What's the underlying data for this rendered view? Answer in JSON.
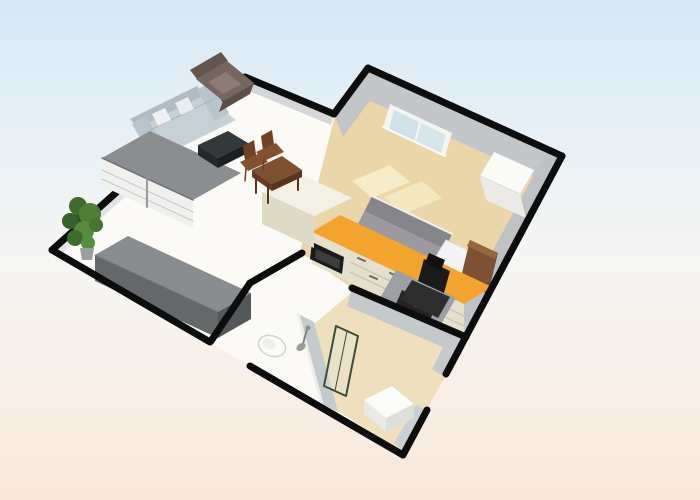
{
  "canvas": {
    "width": 700,
    "height": 500
  },
  "background": {
    "top": "#d7e9f7",
    "mid": "#f6f6f4",
    "bottom": "#f9e8da"
  },
  "scene": {
    "description": "3d-floor-plan-render",
    "shapes": [
      {
        "n": "apartment-floor",
        "t": "poly",
        "p": "52,250 245,77 334,114 368,68 562,156 403,455",
        "f": "#fbfaf6"
      },
      {
        "n": "bedroom-floor",
        "t": "poly",
        "p": "336,112 368,68 562,156 466,337 352,288 300,252",
        "f": "#ebd6a9"
      },
      {
        "n": "bedroom-rug-1",
        "t": "poly",
        "p": "352,181 390,165 410,182 372,198",
        "f": "#f6ecc8"
      },
      {
        "n": "bedroom-rug-2",
        "t": "poly",
        "p": "384,197 422,181 442,198 404,214",
        "f": "#f3e8c0"
      },
      {
        "n": "bathroom-floor",
        "t": "poly",
        "p": "314,324 352,292 466,339 403,452 336,410",
        "f": "#eedfbd"
      },
      {
        "n": "wall-face-top-left",
        "t": "poly",
        "p": "52,250 245,77 251,84 58,257",
        "f": "#e2e3e4"
      },
      {
        "n": "wall-face-notch",
        "t": "poly",
        "p": "245,77 334,114 331,125 242,88",
        "f": "#d4d6d8"
      },
      {
        "n": "wall-face-bedroom-left",
        "t": "poly",
        "p": "334,114 368,68 377,91 343,137",
        "f": "#c2c5c8"
      },
      {
        "n": "wall-face-bedroom-window",
        "t": "poly",
        "p": "368,71 560,159 549,183 357,95",
        "f": "#c4c7ca"
      },
      {
        "n": "window-frame",
        "t": "poly",
        "p": "390,104 452,133 445,156 383,127",
        "f": "#f4f4f1"
      },
      {
        "n": "window-pane-left",
        "t": "poly",
        "p": "394,110 419,122 414,141 389,129",
        "f": "#cfe2e6"
      },
      {
        "n": "window-pane-right",
        "t": "poly",
        "p": "421,123 446,135 441,153 416,142",
        "f": "#d5e7ea"
      },
      {
        "n": "window-sill",
        "t": "line",
        "p": "383,127 445,156",
        "s": "#fdfdfd",
        "w": 2
      },
      {
        "n": "wall-face-bedroom-right",
        "t": "poly",
        "p": "560,159 470,324 457,316 547,151",
        "f": "#bfc2c5"
      },
      {
        "n": "wall-face-bathroom-right",
        "t": "poly",
        "p": "470,324 443,376 432,369 459,317",
        "f": "#c6c9cb"
      },
      {
        "n": "wall-face-bathroom-right-lower",
        "t": "poly",
        "p": "427,413 404,452 394,443 417,404",
        "f": "#cdd0d2"
      },
      {
        "n": "wall-face-bathroom-top",
        "t": "poly",
        "p": "352,288 466,337 461,355 347,306",
        "f": "#c6c9cb"
      },
      {
        "n": "wall-face-bathroom-left",
        "t": "poly",
        "p": "298,314 322,404 338,412 314,322",
        "f": "#c7cacc"
      },
      {
        "n": "wall-edge-bathroom-left",
        "t": "line",
        "p": "298,314 322,404",
        "s": "#eceeee",
        "w": 3
      },
      {
        "n": "shower-arm",
        "t": "line",
        "p": "307,329 303,344",
        "s": "#7f8486",
        "w": 2
      },
      {
        "n": "shower-head",
        "t": "ell",
        "cx": 301,
        "cy": 347,
        "rx": 5,
        "ry": 3.5,
        "rot": -35,
        "f": "#989da0"
      },
      {
        "n": "shower-valve",
        "t": "ell",
        "cx": 308,
        "cy": 328,
        "rx": 2.5,
        "ry": 2.5,
        "rot": 0,
        "f": "#8a8f92"
      },
      {
        "n": "wall-top-left",
        "t": "line",
        "p": "52,250 245,77",
        "s": "#0d0d0d",
        "w": 7
      },
      {
        "n": "wall-notch",
        "t": "line",
        "p": "245,77 334,114",
        "s": "#0d0d0d",
        "w": 7
      },
      {
        "n": "bed-duvet",
        "t": "poly",
        "p": "372,196 452,234 424,290 344,252",
        "f": "#9b9b9e"
      },
      {
        "n": "bed-duvet-fold",
        "t": "poly",
        "p": "372,196 452,234 445,249 365,211",
        "f": "#85858b"
      },
      {
        "n": "bed-edge",
        "t": "line",
        "p": "372,196 452,234",
        "s": "#efeff1",
        "w": 2
      },
      {
        "n": "bed-pillow-1",
        "t": "poly",
        "p": "446,240 482,257 466,283 430,266",
        "f": "#f4f4f6",
        "s": "#dcdce0",
        "w": 1
      },
      {
        "n": "bed-pillow-2",
        "t": "poly",
        "p": "434,264 470,281 456,304 420,287",
        "f": "#ededf0",
        "s": "#d8d8dc",
        "w": 1
      },
      {
        "n": "bed-headboard",
        "t": "poly",
        "p": "470,240 498,253 488,294 460,281",
        "f": "#7c5134"
      },
      {
        "n": "bed-headboard-edge",
        "t": "poly",
        "p": "470,240 498,253 495,259 467,246",
        "f": "#96663e"
      },
      {
        "n": "wardrobe-top",
        "t": "poly",
        "p": "494,152 534,170 520,194 480,176",
        "f": "#fafaf7"
      },
      {
        "n": "wardrobe-front",
        "t": "poly",
        "p": "480,176 520,194 526,218 486,200",
        "f": "#ebeae6"
      },
      {
        "n": "wardrobe-edge",
        "t": "line",
        "p": "480,176 520,194",
        "s": "#dddddb",
        "w": 1
      },
      {
        "n": "kitchen-counter-top",
        "t": "poly",
        "p": "312,232 464,304 492,287 340,215",
        "f": "#f2a42e"
      },
      {
        "n": "kitchen-counter-front",
        "t": "poly",
        "p": "312,232 464,304 464,336 312,264",
        "f": "#e4e0cc"
      },
      {
        "n": "kitchen-drawer-seam",
        "t": "line",
        "p": "350,262 464,316",
        "s": "#cbc7b4",
        "w": 1.5
      },
      {
        "n": "kitchen-drawer-seam",
        "t": "line",
        "p": "350,272 464,326",
        "s": "#cbc7b4",
        "w": 1.5
      },
      {
        "n": "oven",
        "t": "poly",
        "p": "312,242 344,257 342,274 310,259",
        "f": "#1a1a1a"
      },
      {
        "n": "oven-glass",
        "t": "poly",
        "p": "316,249 340,260 339,269 315,258",
        "f": "#3d3d3d"
      },
      {
        "n": "kitchen-drawer-handle",
        "t": "line",
        "p": "358,258 365,261",
        "s": "#6a6a5e",
        "w": 2
      },
      {
        "n": "kitchen-drawer-handle",
        "t": "line",
        "p": "370,276 377,279",
        "s": "#6a6a5e",
        "w": 2
      },
      {
        "n": "kitchen-drawer-handle",
        "t": "line",
        "p": "390,273 397,276",
        "s": "#6a6a5e",
        "w": 2
      },
      {
        "n": "kitchen-drawer-handle",
        "t": "line",
        "p": "402,291 409,294",
        "s": "#6a6a5e",
        "w": 2
      },
      {
        "n": "kitchen-drawer-handle",
        "t": "line",
        "p": "422,288 429,291",
        "s": "#6a6a5e",
        "w": 2
      },
      {
        "n": "kitchen-drawer-handle",
        "t": "line",
        "p": "434,306 441,309",
        "s": "#6a6a5e",
        "w": 2
      },
      {
        "n": "kitchen-tall-cabinet-top",
        "t": "poly",
        "p": "262,192 300,174 352,198 314,216",
        "f": "#f3f1e5"
      },
      {
        "n": "kitchen-tall-cabinet-front",
        "t": "poly",
        "p": "262,192 314,216 314,248 262,224",
        "f": "#dedac5"
      },
      {
        "n": "desk-chair-mat",
        "t": "poly",
        "p": "396,270 456,298 440,326 380,298",
        "f": "#9aa0a3"
      },
      {
        "n": "hob-base",
        "t": "poly",
        "p": "402,290 436,306 430,320 396,304",
        "f": "#232323"
      },
      {
        "n": "hob-burner-red",
        "t": "ell",
        "cx": 417,
        "cy": 303,
        "rx": 7,
        "ry": 4.5,
        "rot": 25,
        "f": "#c22f2b"
      },
      {
        "n": "hob-burner-red-small",
        "t": "ell",
        "cx": 427,
        "cy": 309,
        "rx": 4,
        "ry": 3,
        "rot": 25,
        "f": "#9e1f1f"
      },
      {
        "n": "office-chair-seat",
        "t": "poly",
        "p": "412,280 450,297 438,318 400,299",
        "f": "#2d2d2d"
      },
      {
        "n": "office-chair-back",
        "t": "poly",
        "p": "424,259 450,271 444,293 418,281",
        "f": "#1a1a1a"
      },
      {
        "n": "office-chair-headrest",
        "t": "poly",
        "p": "429,253 445,260 441,270 425,263",
        "f": "#111111"
      },
      {
        "n": "sofa-back",
        "t": "poly",
        "p": "130,119 197,86 205,95 138,128",
        "f": "#b0bbc3"
      },
      {
        "n": "sofa-base",
        "t": "poly",
        "p": "138,128 205,95 236,120 169,153",
        "f": "#c6d0d7"
      },
      {
        "n": "sofa-armrest-left",
        "t": "poly",
        "p": "132,124 146,116 164,147 150,155",
        "f": "#bac4cb"
      },
      {
        "n": "sofa-armrest-right",
        "t": "poly",
        "p": "197,90 211,82 229,113 215,121",
        "f": "#bac4cb"
      },
      {
        "n": "sofa-seam",
        "t": "line",
        "p": "150,130 214,99",
        "s": "#a8b5bd",
        "w": 1
      },
      {
        "n": "sofa-pillow-1",
        "t": "poly",
        "p": "152,114 165,108 171,120 158,126",
        "f": "#eef1f3"
      },
      {
        "n": "sofa-pillow-2",
        "t": "poly",
        "p": "175,103 188,97 194,109 181,115",
        "f": "#e8edf0"
      },
      {
        "n": "sideboard-top",
        "t": "poly",
        "p": "102,158 150,131 241,173 193,200",
        "f": "#8b8e91"
      },
      {
        "n": "sideboard-front",
        "t": "poly",
        "p": "102,158 193,200 193,228 102,186",
        "f": "#f0f0ee"
      },
      {
        "n": "sideboard-edge",
        "t": "line",
        "p": "102,158 193,200",
        "s": "#6f7274",
        "w": 1.5
      },
      {
        "n": "sideboard-seam",
        "t": "line",
        "p": "102,170 193,212",
        "s": "#c6c6c6",
        "w": 1
      },
      {
        "n": "sideboard-seam",
        "t": "line",
        "p": "102,179 193,221",
        "s": "#c6c6c6",
        "w": 1
      },
      {
        "n": "sideboard-divider",
        "t": "line",
        "p": "147,179 147,207",
        "s": "#9a9a9a",
        "w": 2
      },
      {
        "n": "armchair-back",
        "t": "poly",
        "p": "190,70 221,52 228,61 197,79",
        "f": "#64544f"
      },
      {
        "n": "armchair-body",
        "t": "poly",
        "p": "196,79 227,61 254,83 223,101",
        "f": "#776561"
      },
      {
        "n": "armchair-seat",
        "t": "poly",
        "p": "208,82 226,72 241,84 223,94",
        "f": "#8d7b76"
      },
      {
        "n": "armchair-front",
        "t": "poly",
        "p": "223,101 254,83 250,94 219,112",
        "f": "#5e4e4a"
      },
      {
        "n": "coffee-table-top",
        "t": "poly",
        "p": "198,145 228,131 248,143 218,158",
        "f": "#33383a"
      },
      {
        "n": "coffee-table-front",
        "t": "poly",
        "p": "198,145 218,158 218,168 198,155",
        "f": "#24282a"
      },
      {
        "n": "coffee-table-side",
        "t": "poly",
        "p": "218,158 248,143 248,153 218,168",
        "f": "#1d2022"
      },
      {
        "n": "dining-chair-back",
        "t": "poly",
        "p": "261,136 272,130 275,152 264,158",
        "f": "#6f4226"
      },
      {
        "n": "dining-chair-seat",
        "t": "poly",
        "p": "256,152 276,143 284,152 264,161",
        "f": "#82522e"
      },
      {
        "n": "dining-chair-back",
        "t": "poly",
        "p": "243,146 254,140 257,162 246,168",
        "f": "#6f4226"
      },
      {
        "n": "dining-chair-seat",
        "t": "poly",
        "p": "240,162 260,153 268,162 248,171",
        "f": "#82522e"
      },
      {
        "n": "dining-table-top",
        "t": "poly",
        "p": "252,170 282,156 302,170 272,184",
        "f": "#7e5130"
      },
      {
        "n": "dining-table-front",
        "t": "poly",
        "p": "252,170 272,184 272,191 252,177",
        "f": "#663c22"
      },
      {
        "n": "dining-table-side",
        "t": "poly",
        "p": "272,184 302,170 302,177 272,191",
        "f": "#5a341d"
      },
      {
        "n": "dining-table-leg",
        "t": "line",
        "p": "256,176 256,193",
        "s": "#5a341d",
        "w": 2
      },
      {
        "n": "dining-table-leg",
        "t": "line",
        "p": "298,174 298,190",
        "s": "#5a341d",
        "w": 2
      },
      {
        "n": "dining-table-leg",
        "t": "line",
        "p": "268,186 268,203",
        "s": "#5a341d",
        "w": 2
      },
      {
        "n": "dining-chair-leg",
        "t": "line",
        "p": "246,168 245,181",
        "s": "#6f4226",
        "w": 1.5
      },
      {
        "n": "dining-chair-leg",
        "t": "line",
        "p": "264,158 263,171",
        "s": "#6f4226",
        "w": 1.5
      },
      {
        "n": "potted-plant-foliage",
        "t": "ell",
        "cx": 82,
        "cy": 222,
        "rx": 12,
        "ry": 12,
        "rot": 0,
        "f": "#2e5522"
      },
      {
        "n": "potted-plant-foliage",
        "t": "ell",
        "cx": 78,
        "cy": 206,
        "rx": 9,
        "ry": 9,
        "rot": 0,
        "f": "#3e6c2c"
      },
      {
        "n": "potted-plant-foliage",
        "t": "ell",
        "cx": 90,
        "cy": 214,
        "rx": 11,
        "ry": 11,
        "rot": 0,
        "f": "#4d8034"
      },
      {
        "n": "potted-plant-foliage",
        "t": "ell",
        "cx": 70,
        "cy": 221,
        "rx": 8,
        "ry": 8,
        "rot": 0,
        "f": "#35612a"
      },
      {
        "n": "potted-plant-foliage",
        "t": "ell",
        "cx": 84,
        "cy": 231,
        "rx": 10,
        "ry": 10,
        "rot": 0,
        "f": "#578c3c"
      },
      {
        "n": "potted-plant-foliage",
        "t": "ell",
        "cx": 96,
        "cy": 225,
        "rx": 7,
        "ry": 7,
        "rot": 0,
        "f": "#477433"
      },
      {
        "n": "potted-plant-foliage",
        "t": "ell",
        "cx": 75,
        "cy": 238,
        "rx": 8,
        "ry": 8,
        "rot": 0,
        "f": "#3e6c2c"
      },
      {
        "n": "potted-plant-foliage",
        "t": "ell",
        "cx": 88,
        "cy": 243,
        "rx": 7,
        "ry": 7,
        "rot": 0,
        "f": "#529040"
      },
      {
        "n": "plant-pot",
        "t": "poly",
        "p": "80,248 94,248 92,260 82,260",
        "f": "#9aa0a2"
      },
      {
        "n": "storage-box-top",
        "t": "poly",
        "p": "95,255 218,312 251,293 128,236",
        "f": "#898d90"
      },
      {
        "n": "storage-box-front",
        "t": "poly",
        "p": "95,255 218,312 218,338 95,281",
        "f": "#64686b"
      },
      {
        "n": "storage-box-end",
        "t": "poly",
        "p": "218,312 251,293 251,319 218,338",
        "f": "#55585b"
      },
      {
        "n": "storage-box-edge",
        "t": "line",
        "p": "95,255 218,312",
        "s": "#75797c",
        "w": 1
      },
      {
        "n": "toilet-bowl",
        "t": "ell",
        "cx": 272,
        "cy": 346,
        "rx": 14,
        "ry": 10,
        "rot": 22,
        "f": "#fbfbfa",
        "s": "#d2d2d0",
        "w": 1.5
      },
      {
        "n": "toilet-seat",
        "t": "ell",
        "cx": 269,
        "cy": 344,
        "rx": 7,
        "ry": 5,
        "rot": 22,
        "f": "#eeeeec"
      },
      {
        "n": "shower-glass-panel",
        "t": "poly",
        "p": "336,326 358,336 346,396 324,386",
        "f": "#dcebe0",
        "o": 0.3,
        "s": "#3c4d39",
        "w": 2
      },
      {
        "n": "shower-glass-edge",
        "t": "line",
        "p": "347,331 335,391",
        "s": "#3c4d39",
        "w": 1
      },
      {
        "n": "shower-tray-top",
        "t": "poly",
        "p": "364,400 392,386 414,404 386,418",
        "f": "#fbfbf9"
      },
      {
        "n": "shower-tray-left",
        "t": "poly",
        "p": "364,400 386,418 386,432 364,414",
        "f": "#e9e9e6"
      },
      {
        "n": "shower-tray-right",
        "t": "poly",
        "p": "386,418 414,404 414,418 386,432",
        "f": "#dededa"
      },
      {
        "n": "wall-bedroom-left",
        "t": "line",
        "p": "334,114 368,68",
        "s": "#0d0d0d",
        "w": 7
      },
      {
        "n": "wall-bedroom-top",
        "t": "line",
        "p": "368,68 562,156",
        "s": "#0d0d0d",
        "w": 7
      },
      {
        "n": "wall-right-upper",
        "t": "line",
        "p": "562,156 446,374",
        "s": "#0d0d0d",
        "w": 7
      },
      {
        "n": "wall-right-lower",
        "t": "line",
        "p": "427,410 403,455",
        "s": "#0d0d0d",
        "w": 7
      },
      {
        "n": "wall-bottom-left",
        "t": "line",
        "p": "52,250 210,342",
        "s": "#0d0d0d",
        "w": 7
      },
      {
        "n": "wall-bottom-right",
        "t": "line",
        "p": "250,366 403,455",
        "s": "#0d0d0d",
        "w": 7
      },
      {
        "n": "wall-corridor",
        "t": "line",
        "p": "250,283 211,341",
        "s": "#0d0d0d",
        "w": 7
      },
      {
        "n": "wall-kitchen-entry",
        "t": "line",
        "p": "250,283 302,253",
        "s": "#0d0d0d",
        "w": 7
      },
      {
        "n": "wall-bathroom-top",
        "t": "line",
        "p": "352,288 466,337",
        "s": "#0d0d0d",
        "w": 7
      }
    ]
  }
}
